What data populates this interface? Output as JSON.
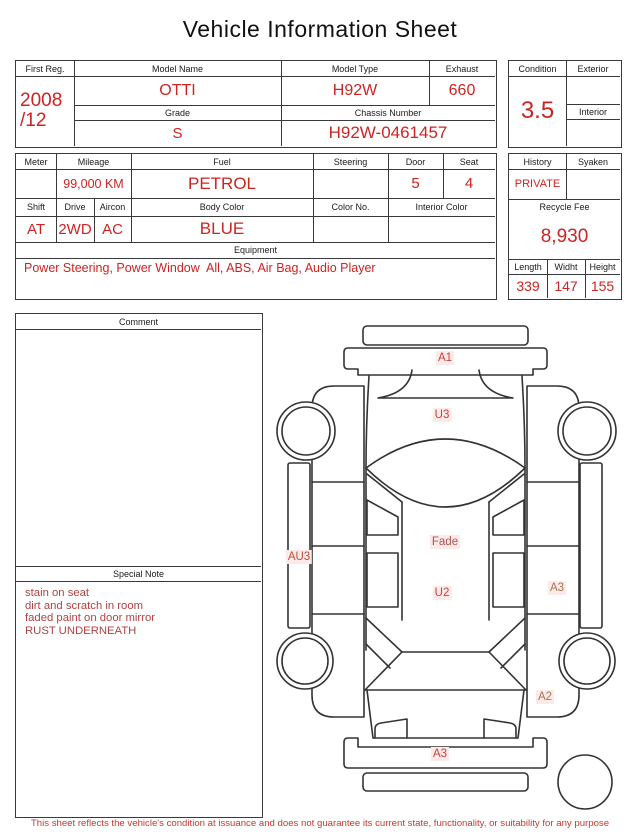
{
  "title": "Vehicle Information Sheet",
  "colors": {
    "value_red": "#cc2420",
    "note_red": "#b34141",
    "footer_red": "#c13a2c",
    "border_dark": "#3a3a3a",
    "label_bg": "#fbeae8"
  },
  "info_table": {
    "first_reg": {
      "label": "First Reg.",
      "value": "2008\n/12"
    },
    "model_name": {
      "label": "Model Name",
      "value": "OTTI"
    },
    "model_type": {
      "label": "Model Type",
      "value": "H92W"
    },
    "exhaust": {
      "label": "Exhaust",
      "value": "660"
    },
    "grade": {
      "label": "Grade",
      "value": "S"
    },
    "chassis_number": {
      "label": "Chassis Number",
      "value": "H92W-0461457"
    }
  },
  "condition_panel": {
    "condition": {
      "label": "Condition",
      "value": "3.5"
    },
    "exterior": {
      "label": "Exterior",
      "value": ""
    },
    "interior": {
      "label": "Interior",
      "value": ""
    }
  },
  "spec_table": {
    "meter": {
      "label": "Meter",
      "value": ""
    },
    "mileage": {
      "label": "Mileage",
      "value": "99,000 KM"
    },
    "fuel": {
      "label": "Fuel",
      "value": "PETROL"
    },
    "steering": {
      "label": "Steering",
      "value": ""
    },
    "door": {
      "label": "Door",
      "value": "5"
    },
    "seat": {
      "label": "Seat",
      "value": "4"
    },
    "shift": {
      "label": "Shift",
      "value": "AT"
    },
    "drive": {
      "label": "Drive",
      "value": "2WD"
    },
    "aircon": {
      "label": "Aircon",
      "value": "AC"
    },
    "body_color": {
      "label": "Body Color",
      "value": "BLUE"
    },
    "color_no": {
      "label": "Color No.",
      "value": ""
    },
    "interior_color": {
      "label": "Interior Color",
      "value": ""
    },
    "equipment": {
      "label": "Equipment",
      "value": "Power Steering, Power Window  All, ABS, Air Bag, Audio Player"
    }
  },
  "history_panel": {
    "history": {
      "label": "History",
      "value": "PRIVATE"
    },
    "syaken": {
      "label": "Syaken",
      "value": ""
    },
    "recycle_fee": {
      "label": "Recycle Fee",
      "value": "8,930"
    },
    "length": {
      "label": "Length",
      "value": "339"
    },
    "width": {
      "label": "Widht",
      "value": "147"
    },
    "height": {
      "label": "Height",
      "value": "155"
    }
  },
  "comment": {
    "label": "Comment",
    "value": ""
  },
  "special_note": {
    "label": "Special Note",
    "lines": [
      "stain on seat",
      "dirt and scratch in room",
      "faded paint on door mirror",
      "RUST UNDERNEATH"
    ]
  },
  "diagram": {
    "labels": [
      {
        "text": "A1",
        "color": "#cc4040"
      },
      {
        "text": "U3",
        "color": "#cc4040"
      },
      {
        "text": "Fade",
        "color": "#b05252"
      },
      {
        "text": "AU3",
        "color": "#c14e3e"
      },
      {
        "text": "U2",
        "color": "#cc4040"
      },
      {
        "text": "A3",
        "color": "#a8764f"
      },
      {
        "text": "A2",
        "color": "#a8764f"
      },
      {
        "text": "A3",
        "color": "#cc4040"
      }
    ]
  },
  "footer": "This sheet reflects the vehicle's condition at issuance and does not guarantee its current state, functionality, or suitability for any purpose"
}
